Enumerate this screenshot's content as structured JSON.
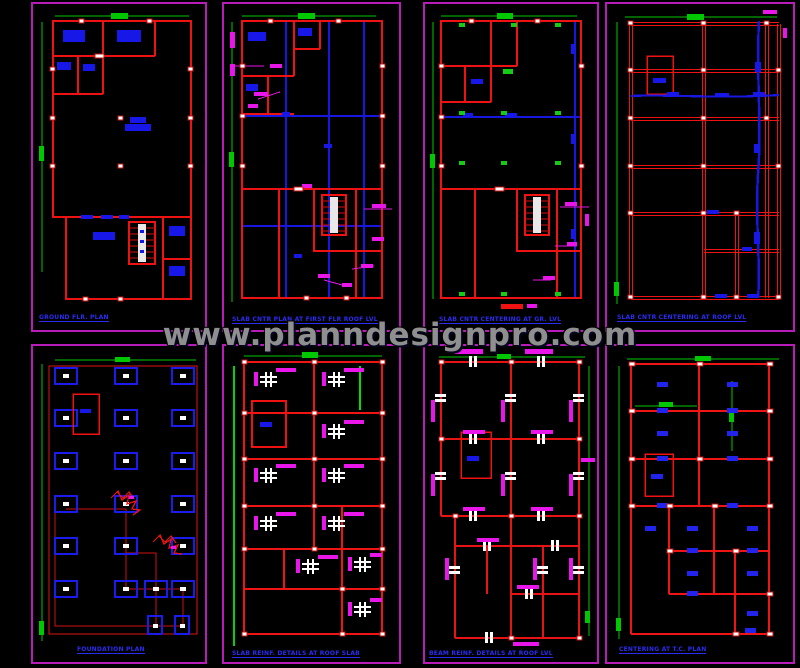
{
  "watermark": {
    "text": "www.planndesignpro.com"
  },
  "colors": {
    "background": "#000000",
    "panel_frame": "#b81cb8",
    "walls_red": "#ef1212",
    "beams_blue": "#1717e8",
    "dimensions_green": "#00c800",
    "annotations_magenta": "#e816e8",
    "rebar_white": "#ffffff",
    "title_blue": "#2b2bf2",
    "watermark_gray": "#8f8f8f"
  },
  "panels": [
    {
      "id": "ground-floor-plan",
      "title": "GROUND FLR. PLAN"
    },
    {
      "id": "slab-centering-first-floor",
      "title": "SLAB CNTR PLAN AT FIRST FLR ROOF LVL"
    },
    {
      "id": "slab-centering-ground-level",
      "title": "SLAB CNTR CENTERING AT GR. LVL"
    },
    {
      "id": "slab-centering-roof-level",
      "title": "SLAB CNTR CENTERING AT ROOF LVL"
    },
    {
      "id": "foundation-plan",
      "title": "FOUNDATION PLAN"
    },
    {
      "id": "slab-reinforcement-plan",
      "title": "SLAB REINF. DETAILS AT ROOF SLAB"
    },
    {
      "id": "beam-reinforcement-plan",
      "title": "BEAM REINF. DETAILS AT ROOF LVL"
    },
    {
      "id": "centering-tc-plan",
      "title": "CENTERING AT T.C. PLAN"
    }
  ]
}
